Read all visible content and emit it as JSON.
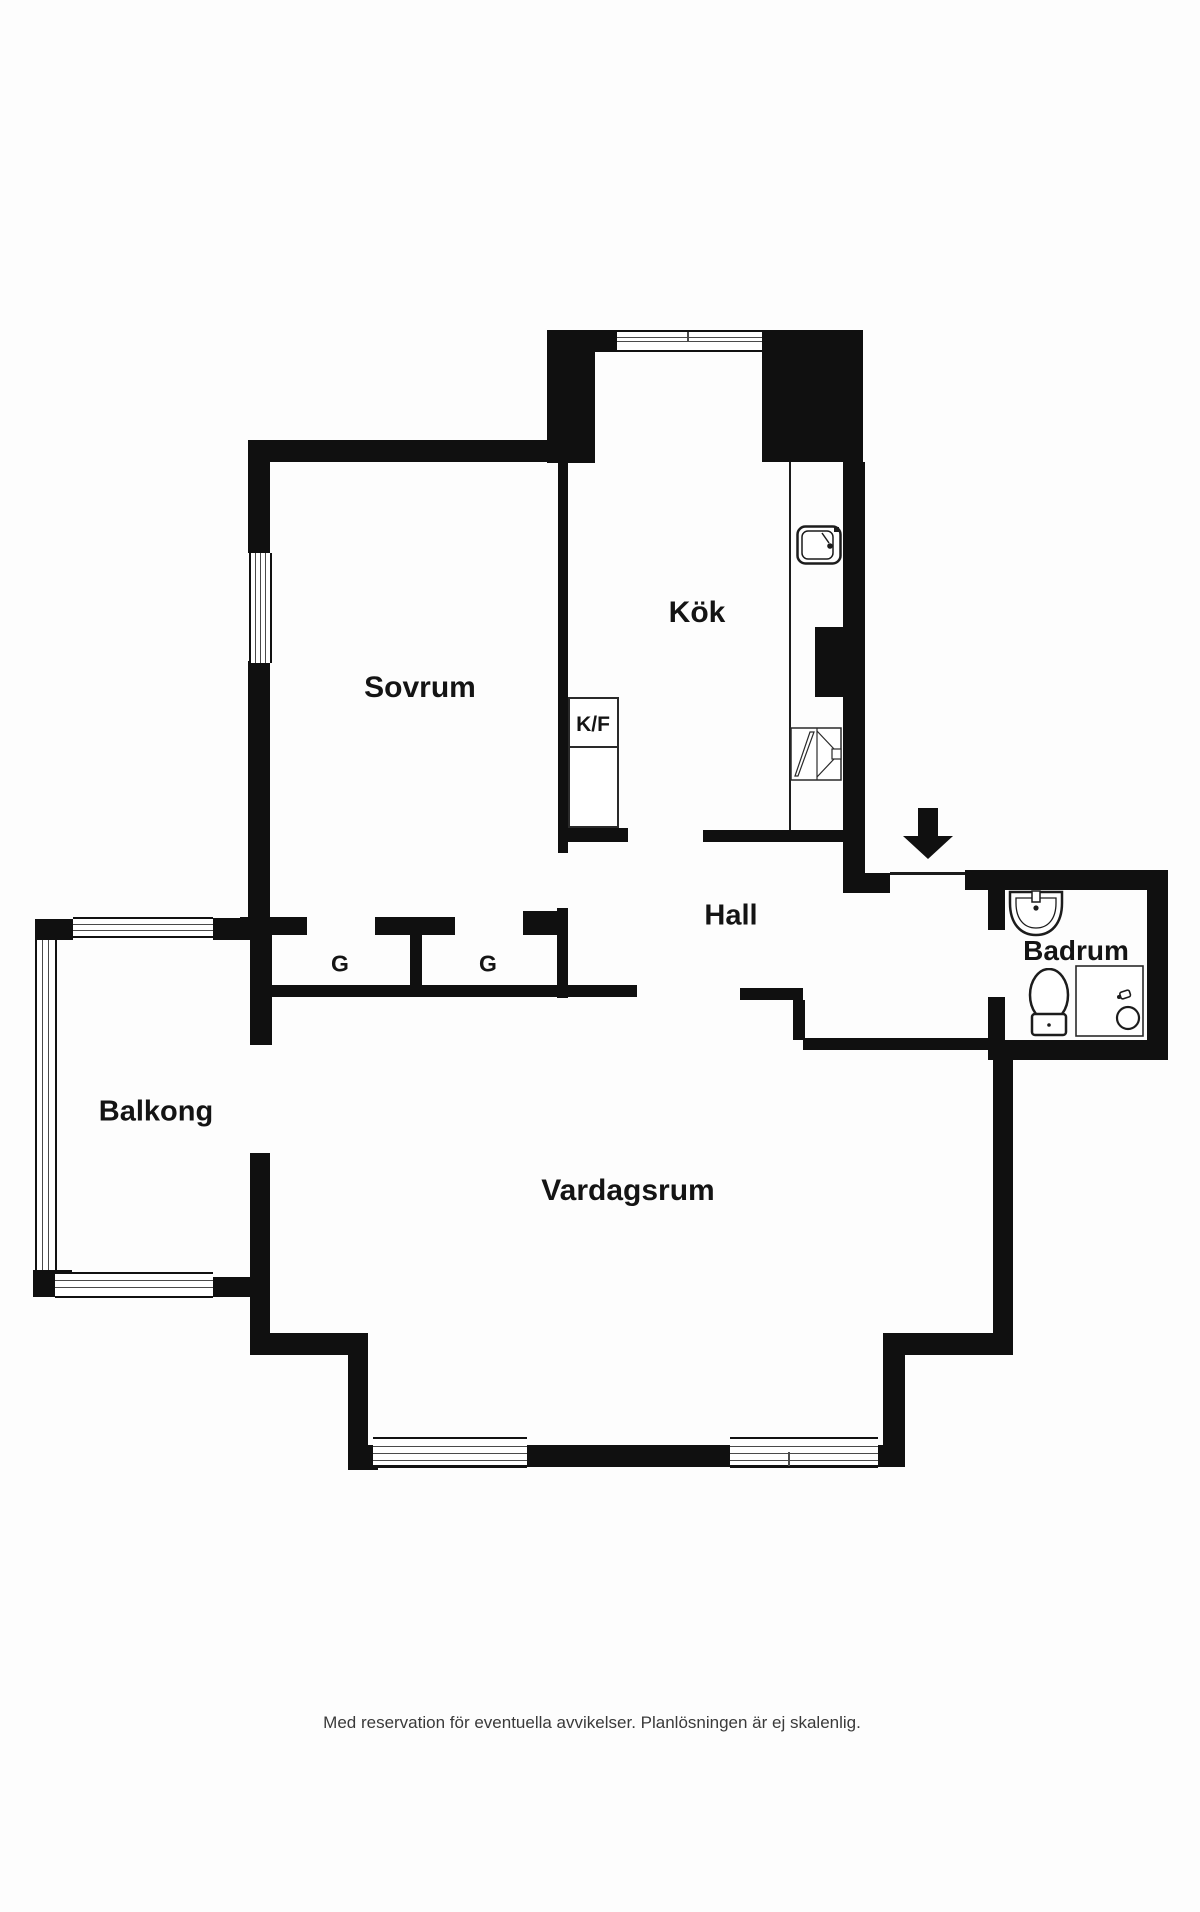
{
  "labels": {
    "sovrum": "Sovrum",
    "kok": "Kök",
    "kf": "K/F",
    "hall": "Hall",
    "badrum": "Badrum",
    "balkong": "Balkong",
    "vardagsrum": "Vardagsrum",
    "g1": "G",
    "g2": "G"
  },
  "caption": "Med reservation för eventuella avvikelser. Planlösningen är ej skalenlig.",
  "colors": {
    "wall": "#101010",
    "fixture_outline": "#1c1c1c",
    "background": "#fdfdfd"
  },
  "icons": {
    "entrance_arrow": "filled-down-arrow",
    "sink": "kitchen-sink",
    "stove": "stove-oven",
    "washbasin": "washbasin",
    "toilet": "toilet",
    "shower": "shower-with-drain",
    "windows": "striped-window-band",
    "balcony_rail": "striped-railing"
  }
}
